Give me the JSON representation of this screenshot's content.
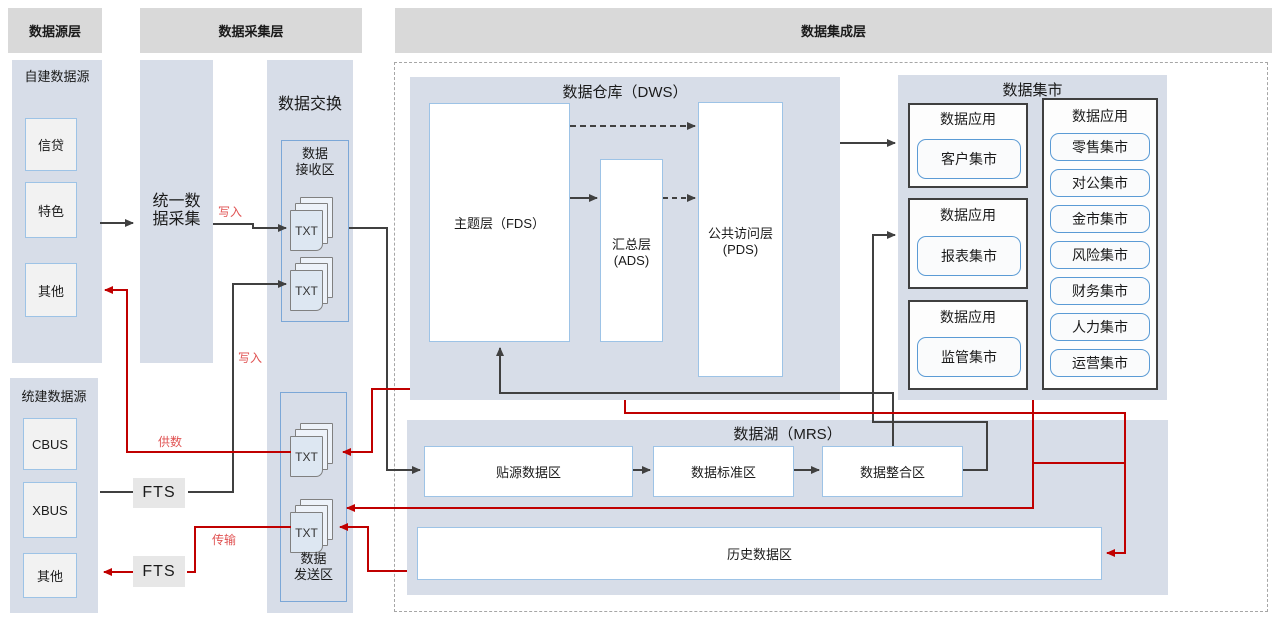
{
  "headers": {
    "source_layer": "数据源层",
    "collection_layer": "数据采集层",
    "integration_layer": "数据集成层"
  },
  "source": {
    "self_built": {
      "title": "自建数据源",
      "items": [
        "信贷",
        "特色",
        "其他"
      ]
    },
    "unified": {
      "title": "统建数据源",
      "items": [
        "CBUS",
        "XBUS",
        "其他"
      ]
    }
  },
  "collection": {
    "unified_collect": "统一数\n据采集",
    "fts_upper": "FTS",
    "fts_lower": "FTS"
  },
  "exchange": {
    "title": "数据交换",
    "receive_title": "数据\n接收区",
    "send_title": "数据\n发送区",
    "file_label": "TXT"
  },
  "edge_labels": {
    "write_upper": "写入",
    "write_lower": "写入",
    "supply": "供数",
    "transfer": "传输"
  },
  "dws": {
    "title": "数据仓库（DWS）",
    "fds": "主题层（FDS）",
    "ads": "汇总层\n(ADS)",
    "pds": "公共访问层\n(PDS)"
  },
  "mart": {
    "title": "数据集市",
    "apps": [
      {
        "title": "数据应用",
        "items": [
          "客户集市"
        ]
      },
      {
        "title": "数据应用",
        "items": [
          "报表集市"
        ]
      },
      {
        "title": "数据应用",
        "items": [
          "监管集市"
        ]
      },
      {
        "title": "数据应用",
        "items": [
          "零售集市",
          "对公集市",
          "金市集市",
          "风险集市",
          "财务集市",
          "人力集市",
          "运营集市"
        ]
      }
    ]
  },
  "mrs": {
    "title": "数据湖（MRS）",
    "zones": [
      "贴源数据区",
      "数据标准区",
      "数据整合区"
    ],
    "history": "历史数据区"
  },
  "colors": {
    "black_line": "#404040",
    "red_line": "#c00000",
    "red_label": "#e05252",
    "panel": "#d7dde8",
    "header": "#d9d9d9",
    "blue_border": "#9dc3e6",
    "mart_item_border": "#5b9bd5"
  }
}
